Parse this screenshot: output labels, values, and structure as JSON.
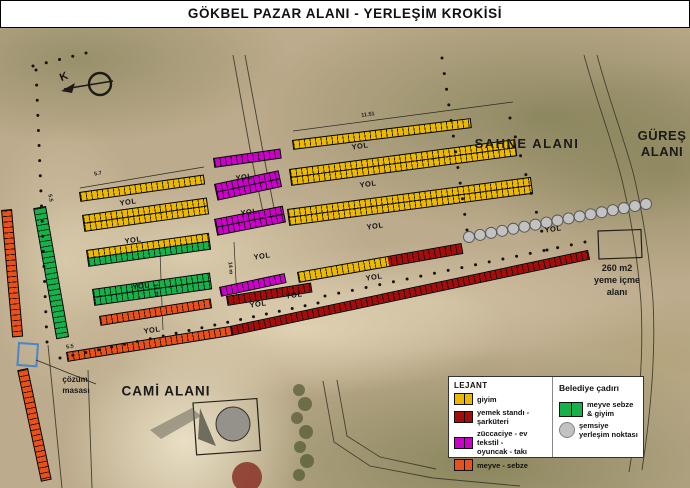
{
  "title": "GÖKBEL PAZAR ALANI - YERLEŞİM KROKİSİ",
  "north_label": "K",
  "road_label": "YOL",
  "area_labels": {
    "sahne": "SAHNE ALANI",
    "gures": "GÜREŞ\nALANI",
    "cami": "CAMİ ALANI",
    "cozum": "çözüm\nmasası",
    "yeme_icme": "260 m2\nyeme içme\nalanı"
  },
  "legend": {
    "left_title": "LEJANT",
    "left_items": [
      {
        "label": "giyim",
        "color_key": "yellow"
      },
      {
        "label": "yemek standı -\nşarküteri",
        "color_key": "darkred"
      },
      {
        "label": "züccaciye - ev tekstil -\noyuncak - takı",
        "color_key": "magenta"
      },
      {
        "label": "meyve - sebze",
        "color_key": "orange"
      }
    ],
    "right_title": "Belediye çadırı",
    "right_items": [
      {
        "label": "meyve sebze & giyim",
        "color_key": "green",
        "shape": "swatch"
      },
      {
        "label": "şemsiye\nyerleşim noktası",
        "color_key": "gray",
        "shape": "circle"
      }
    ]
  },
  "colors": {
    "yellow": "#eab900",
    "darkred": "#a50d0d",
    "magenta": "#cb00cb",
    "orange": "#e8501c",
    "green": "#16b14a",
    "gray": "#c2c2c2"
  },
  "stall_rows": [
    {
      "x": 12,
      "y": 209,
      "len": 128,
      "h": 11,
      "angle": 85,
      "colors": [
        "orange"
      ]
    },
    {
      "x": 46,
      "y": 206,
      "len": 133,
      "h": 13,
      "angle": 80,
      "colors": [
        "green"
      ]
    },
    {
      "x": 28,
      "y": 368,
      "len": 114,
      "h": 11,
      "angle": 78,
      "colors": [
        "orange"
      ]
    },
    {
      "x": 79,
      "y": 192,
      "len": 126,
      "h": 10,
      "angle": -8,
      "colors": [
        "yellow"
      ]
    },
    {
      "x": 82,
      "y": 215,
      "len": 126,
      "h": 17,
      "angle": -8,
      "colors": [
        "yellow",
        "yellow"
      ]
    },
    {
      "x": 86,
      "y": 250,
      "len": 124,
      "h": 17,
      "angle": -8,
      "colors": [
        "yellow",
        "green"
      ]
    },
    {
      "x": 92,
      "y": 289,
      "len": 119,
      "h": 17,
      "angle": -8,
      "colors": [
        "green",
        "green"
      ]
    },
    {
      "x": 99,
      "y": 316,
      "len": 113,
      "h": 10,
      "angle": -9,
      "colors": [
        "orange"
      ]
    },
    {
      "x": 66,
      "y": 352,
      "len": 167,
      "h": 10,
      "angle": -9,
      "colors": [
        "orange"
      ]
    },
    {
      "x": 230,
      "y": 326,
      "len": 366,
      "h": 10,
      "angle": -12,
      "colors": [
        "darkred"
      ]
    },
    {
      "x": 226,
      "y": 296,
      "len": 86,
      "h": 10,
      "angle": -9,
      "colors": [
        "darkred"
      ]
    },
    {
      "x": 297,
      "y": 272,
      "len": 167,
      "h": 11,
      "angle": -10,
      "segments": [
        [
          "yellow",
          55
        ],
        [
          "darkred",
          45
        ]
      ]
    },
    {
      "x": 213,
      "y": 158,
      "len": 68,
      "h": 10,
      "angle": -8,
      "colors": [
        "magenta"
      ]
    },
    {
      "x": 214,
      "y": 184,
      "len": 66,
      "h": 17,
      "angle": -12,
      "colors": [
        "magenta",
        "magenta"
      ]
    },
    {
      "x": 214,
      "y": 219,
      "len": 70,
      "h": 17,
      "angle": -11,
      "colors": [
        "magenta",
        "magenta"
      ]
    },
    {
      "x": 219,
      "y": 287,
      "len": 67,
      "h": 10,
      "angle": -12,
      "colors": [
        "magenta"
      ]
    },
    {
      "x": 292,
      "y": 140,
      "len": 180,
      "h": 10,
      "angle": -7,
      "colors": [
        "yellow"
      ]
    },
    {
      "x": 289,
      "y": 169,
      "len": 228,
      "h": 17,
      "angle": -7.5,
      "colors": [
        "yellow",
        "yellow"
      ]
    },
    {
      "x": 287,
      "y": 209,
      "len": 246,
      "h": 17,
      "angle": -7.5,
      "colors": [
        "yellow",
        "yellow"
      ]
    }
  ],
  "yol_labels": [
    {
      "x": 128,
      "y": 202
    },
    {
      "x": 133,
      "y": 240
    },
    {
      "x": 141,
      "y": 286
    },
    {
      "x": 152,
      "y": 330
    },
    {
      "x": 244,
      "y": 177
    },
    {
      "x": 249,
      "y": 212
    },
    {
      "x": 262,
      "y": 256
    },
    {
      "x": 360,
      "y": 146
    },
    {
      "x": 368,
      "y": 184
    },
    {
      "x": 375,
      "y": 226
    },
    {
      "x": 374,
      "y": 277
    },
    {
      "x": 294,
      "y": 295
    },
    {
      "x": 258,
      "y": 304
    },
    {
      "x": 553,
      "y": 229
    }
  ],
  "dimension_labels": [
    {
      "t": "5.7",
      "x": 98,
      "y": 174,
      "rot": -9
    },
    {
      "t": "11.51",
      "x": 368,
      "y": 115,
      "rot": -7
    },
    {
      "t": "14 m",
      "x": 156,
      "y": 290,
      "rot": 85
    },
    {
      "t": "14 m",
      "x": 230,
      "y": 268,
      "rot": 85
    },
    {
      "t": "5.5",
      "x": 50,
      "y": 198,
      "rot": 78
    },
    {
      "t": "5.5",
      "x": 70,
      "y": 347,
      "rot": -9
    }
  ],
  "umbrella_line": {
    "x1": 469,
    "y1": 237,
    "x2": 646,
    "y2": 204,
    "count": 17,
    "r": 5.5
  },
  "boundary_dot_lines": [
    {
      "x1": 36,
      "y1": 70,
      "x2": 47,
      "y2": 342,
      "n": 19
    },
    {
      "x1": 33,
      "y1": 66,
      "x2": 86,
      "y2": 53,
      "n": 5
    },
    {
      "x1": 442,
      "y1": 58,
      "x2": 467,
      "y2": 230,
      "n": 12
    },
    {
      "x1": 510,
      "y1": 118,
      "x2": 547,
      "y2": 250,
      "n": 8
    },
    {
      "x1": 60,
      "y1": 358,
      "x2": 318,
      "y2": 303,
      "n": 21
    },
    {
      "x1": 325,
      "y1": 296,
      "x2": 585,
      "y2": 242,
      "n": 20
    }
  ]
}
